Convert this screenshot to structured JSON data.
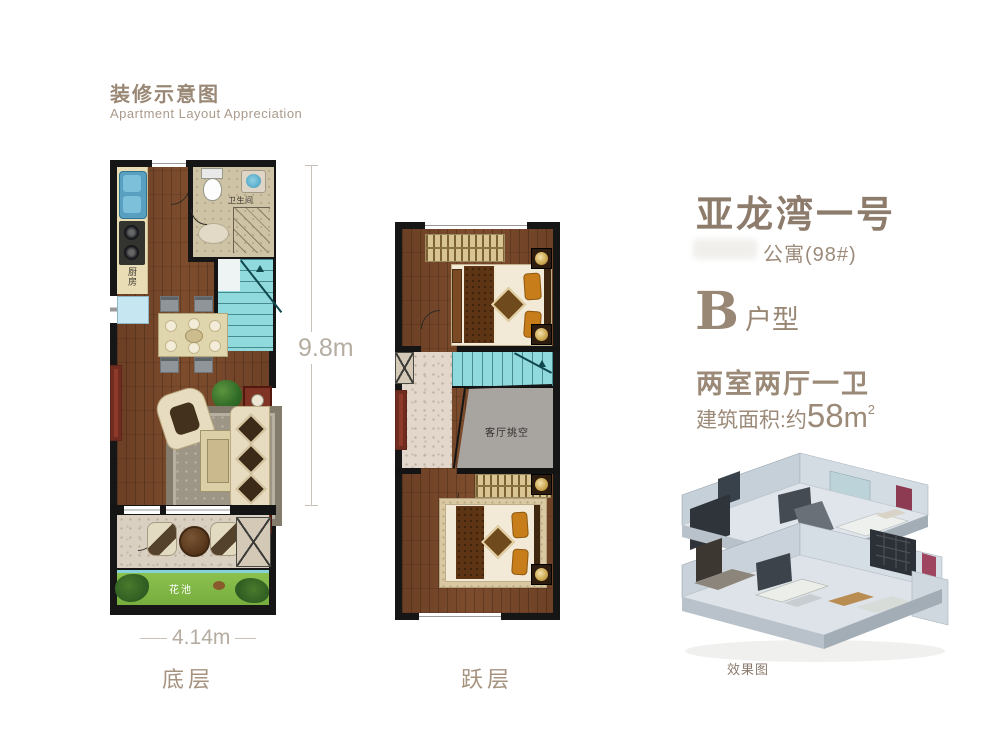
{
  "header": {
    "title": "装修示意图",
    "subtitle": "Apartment Layout Appreciation"
  },
  "listing": {
    "project_name": "亚龙湾一号",
    "building_line": "公寓(98#)",
    "type_letter": "B",
    "type_label": "户型",
    "rooms": "两室两厅一卫",
    "area": {
      "prefix": "建筑面积:约",
      "value": "58",
      "unit": "m",
      "exp": "2"
    }
  },
  "ground_floor": {
    "label": "底层",
    "dim_width": "4.14m",
    "dim_height": "9.8m",
    "kitchen": "厨房",
    "bathroom": "卫生间",
    "flower_bed": "花池"
  },
  "upper_floor": {
    "label": "跃层",
    "void": "客厅挑空"
  },
  "render": {
    "caption": "效果图"
  },
  "colors": {
    "accent_text": "#9a8877",
    "wall": "#161616",
    "wood_floor": "#76462a",
    "stairs_teal": "#90d9dc",
    "flowerbed_green": "#83bc4a",
    "void_gray": "#a8a5a0",
    "dim_text": "#b5aca2"
  }
}
